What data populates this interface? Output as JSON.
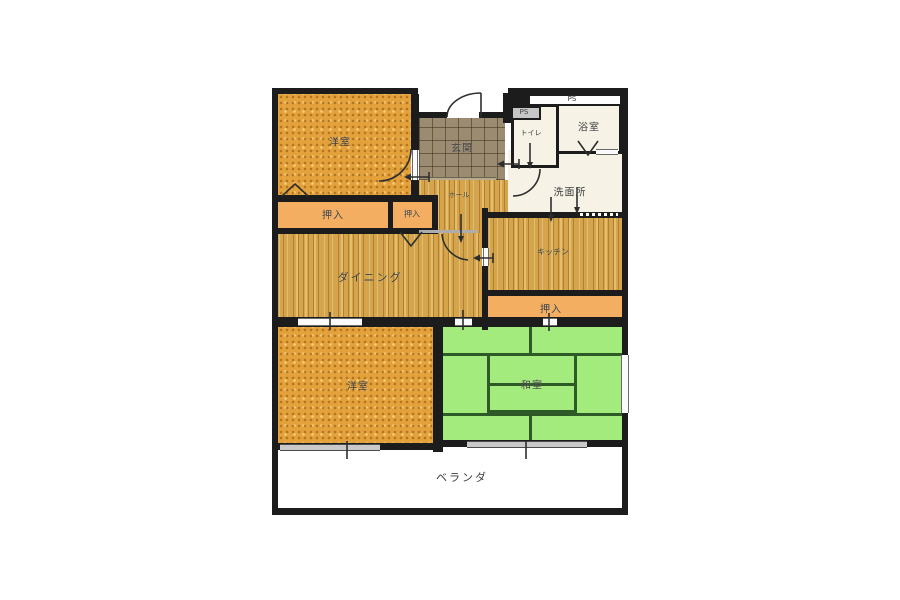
{
  "plan": {
    "type": "apartment-floor-plan",
    "rooms": {
      "yoshitsu1": {
        "label": "洋室"
      },
      "genkan": {
        "label": "玄関"
      },
      "ps_top": {
        "label": "PS"
      },
      "ps_small": {
        "label": "PS"
      },
      "toilet": {
        "label": "トイレ"
      },
      "bath": {
        "label": "浴室"
      },
      "washroom": {
        "label": "洗面所"
      },
      "hall": {
        "label": "ホール"
      },
      "oshiire1": {
        "label": "押入"
      },
      "oshiire2": {
        "label": "押入"
      },
      "dining": {
        "label": "ダイニング"
      },
      "kitchen": {
        "label": "キッチン"
      },
      "oshiire3": {
        "label": "押入"
      },
      "yoshitsu2": {
        "label": "洋室"
      },
      "washitsu": {
        "label": "和室"
      },
      "veranda": {
        "label": "ベランダ"
      }
    },
    "colors": {
      "wall": "#1c1c1c",
      "western_room": "#e3a23c",
      "wood_floor": "#d6a54b",
      "closet": "#f3ae62",
      "entrance_tile": "#9b8b70",
      "wet_rooms": "#f6f3e6",
      "tatami_room": "#a4eb7e",
      "tatami_line": "#2d5a27",
      "window": "#c9c9c9"
    }
  }
}
